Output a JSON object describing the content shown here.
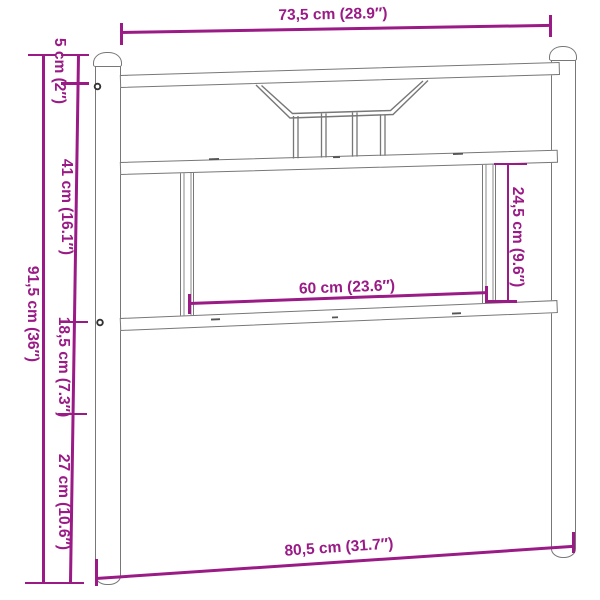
{
  "diagram": {
    "product": "headboard",
    "view": "front-elevation-dimension-drawing",
    "labels": {
      "top_width": "73,5 cm (28.9″)",
      "bottom_width": "80,5 cm (31.7″)",
      "total_height": "91,5 cm (36″)",
      "cap_height": "5 cm (2″)",
      "upper_height": "41 cm (16.1″)",
      "middle_height": "18,5 cm (7.3″)",
      "lower_height": "27 cm (10.6″)",
      "panel_height": "24,5 cm (9.6″)",
      "panel_width": "60 cm (23.6″)"
    },
    "colors": {
      "dimension_line": "#9a1a86",
      "structure_outline": "#777777",
      "background": "#ffffff"
    }
  }
}
